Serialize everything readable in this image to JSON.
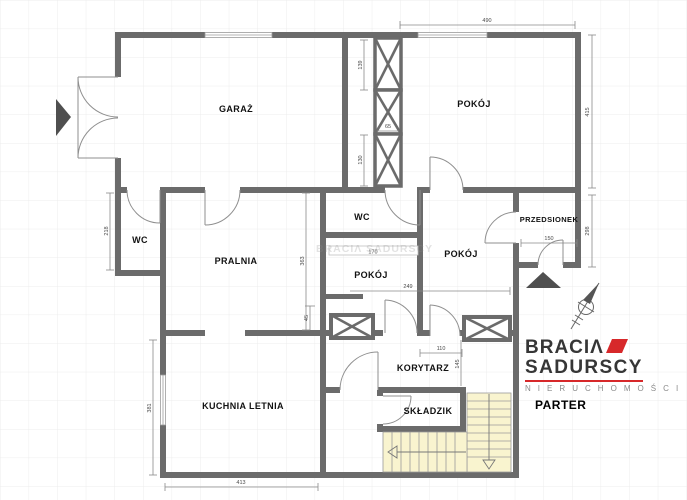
{
  "plan": {
    "rooms": {
      "garaz": {
        "label": "GARAŻ"
      },
      "pokoj_top": {
        "label": "POKÓJ"
      },
      "przedsionek": {
        "label": "PRZEDSIONEK"
      },
      "wc_left": {
        "label": "WC"
      },
      "pralnia": {
        "label": "PRALNIA"
      },
      "wc_center": {
        "label": "WC"
      },
      "pokoj_center_left": {
        "label": "POKÓJ"
      },
      "pokoj_center_right": {
        "label": "POKÓJ"
      },
      "kuchnia_letnia": {
        "label": "KUCHNIA LETNIA"
      },
      "korytarz": {
        "label": "KORYTARZ"
      },
      "skladzik": {
        "label": "SKŁADZIK"
      }
    },
    "dimensions_cm": {
      "pokoj_top_width": "490",
      "pokoj_top_height": "415",
      "przedsionek_height": "298",
      "shaft_top": "139",
      "shaft_mid": "65",
      "shaft_bottom": "130",
      "wc_left_height": "218",
      "pralnia_height": "363",
      "chimney_offset": "45",
      "wardrobe_width": "170",
      "pokoj_center_right_width": "249",
      "przedsionek_door_width": "150",
      "korytarz_opening_width": "110",
      "korytarz_depth": "145",
      "kuchnia_height": "381",
      "kuchnia_width": "413"
    },
    "watermark": "BRACIΛ SADURSCY"
  },
  "branding": {
    "line1": "BRACIΛ",
    "line2": "SADURSCY",
    "subtitle": "N I E R U C H O M O Ś C I",
    "floor_label": "PARTER"
  },
  "colors": {
    "wall": "#6b6b6b",
    "stairs_fill": "#f9f4cf",
    "accent_red": "#d7282a",
    "grid": "#ececec",
    "dim_text": "#4a4a4a"
  }
}
